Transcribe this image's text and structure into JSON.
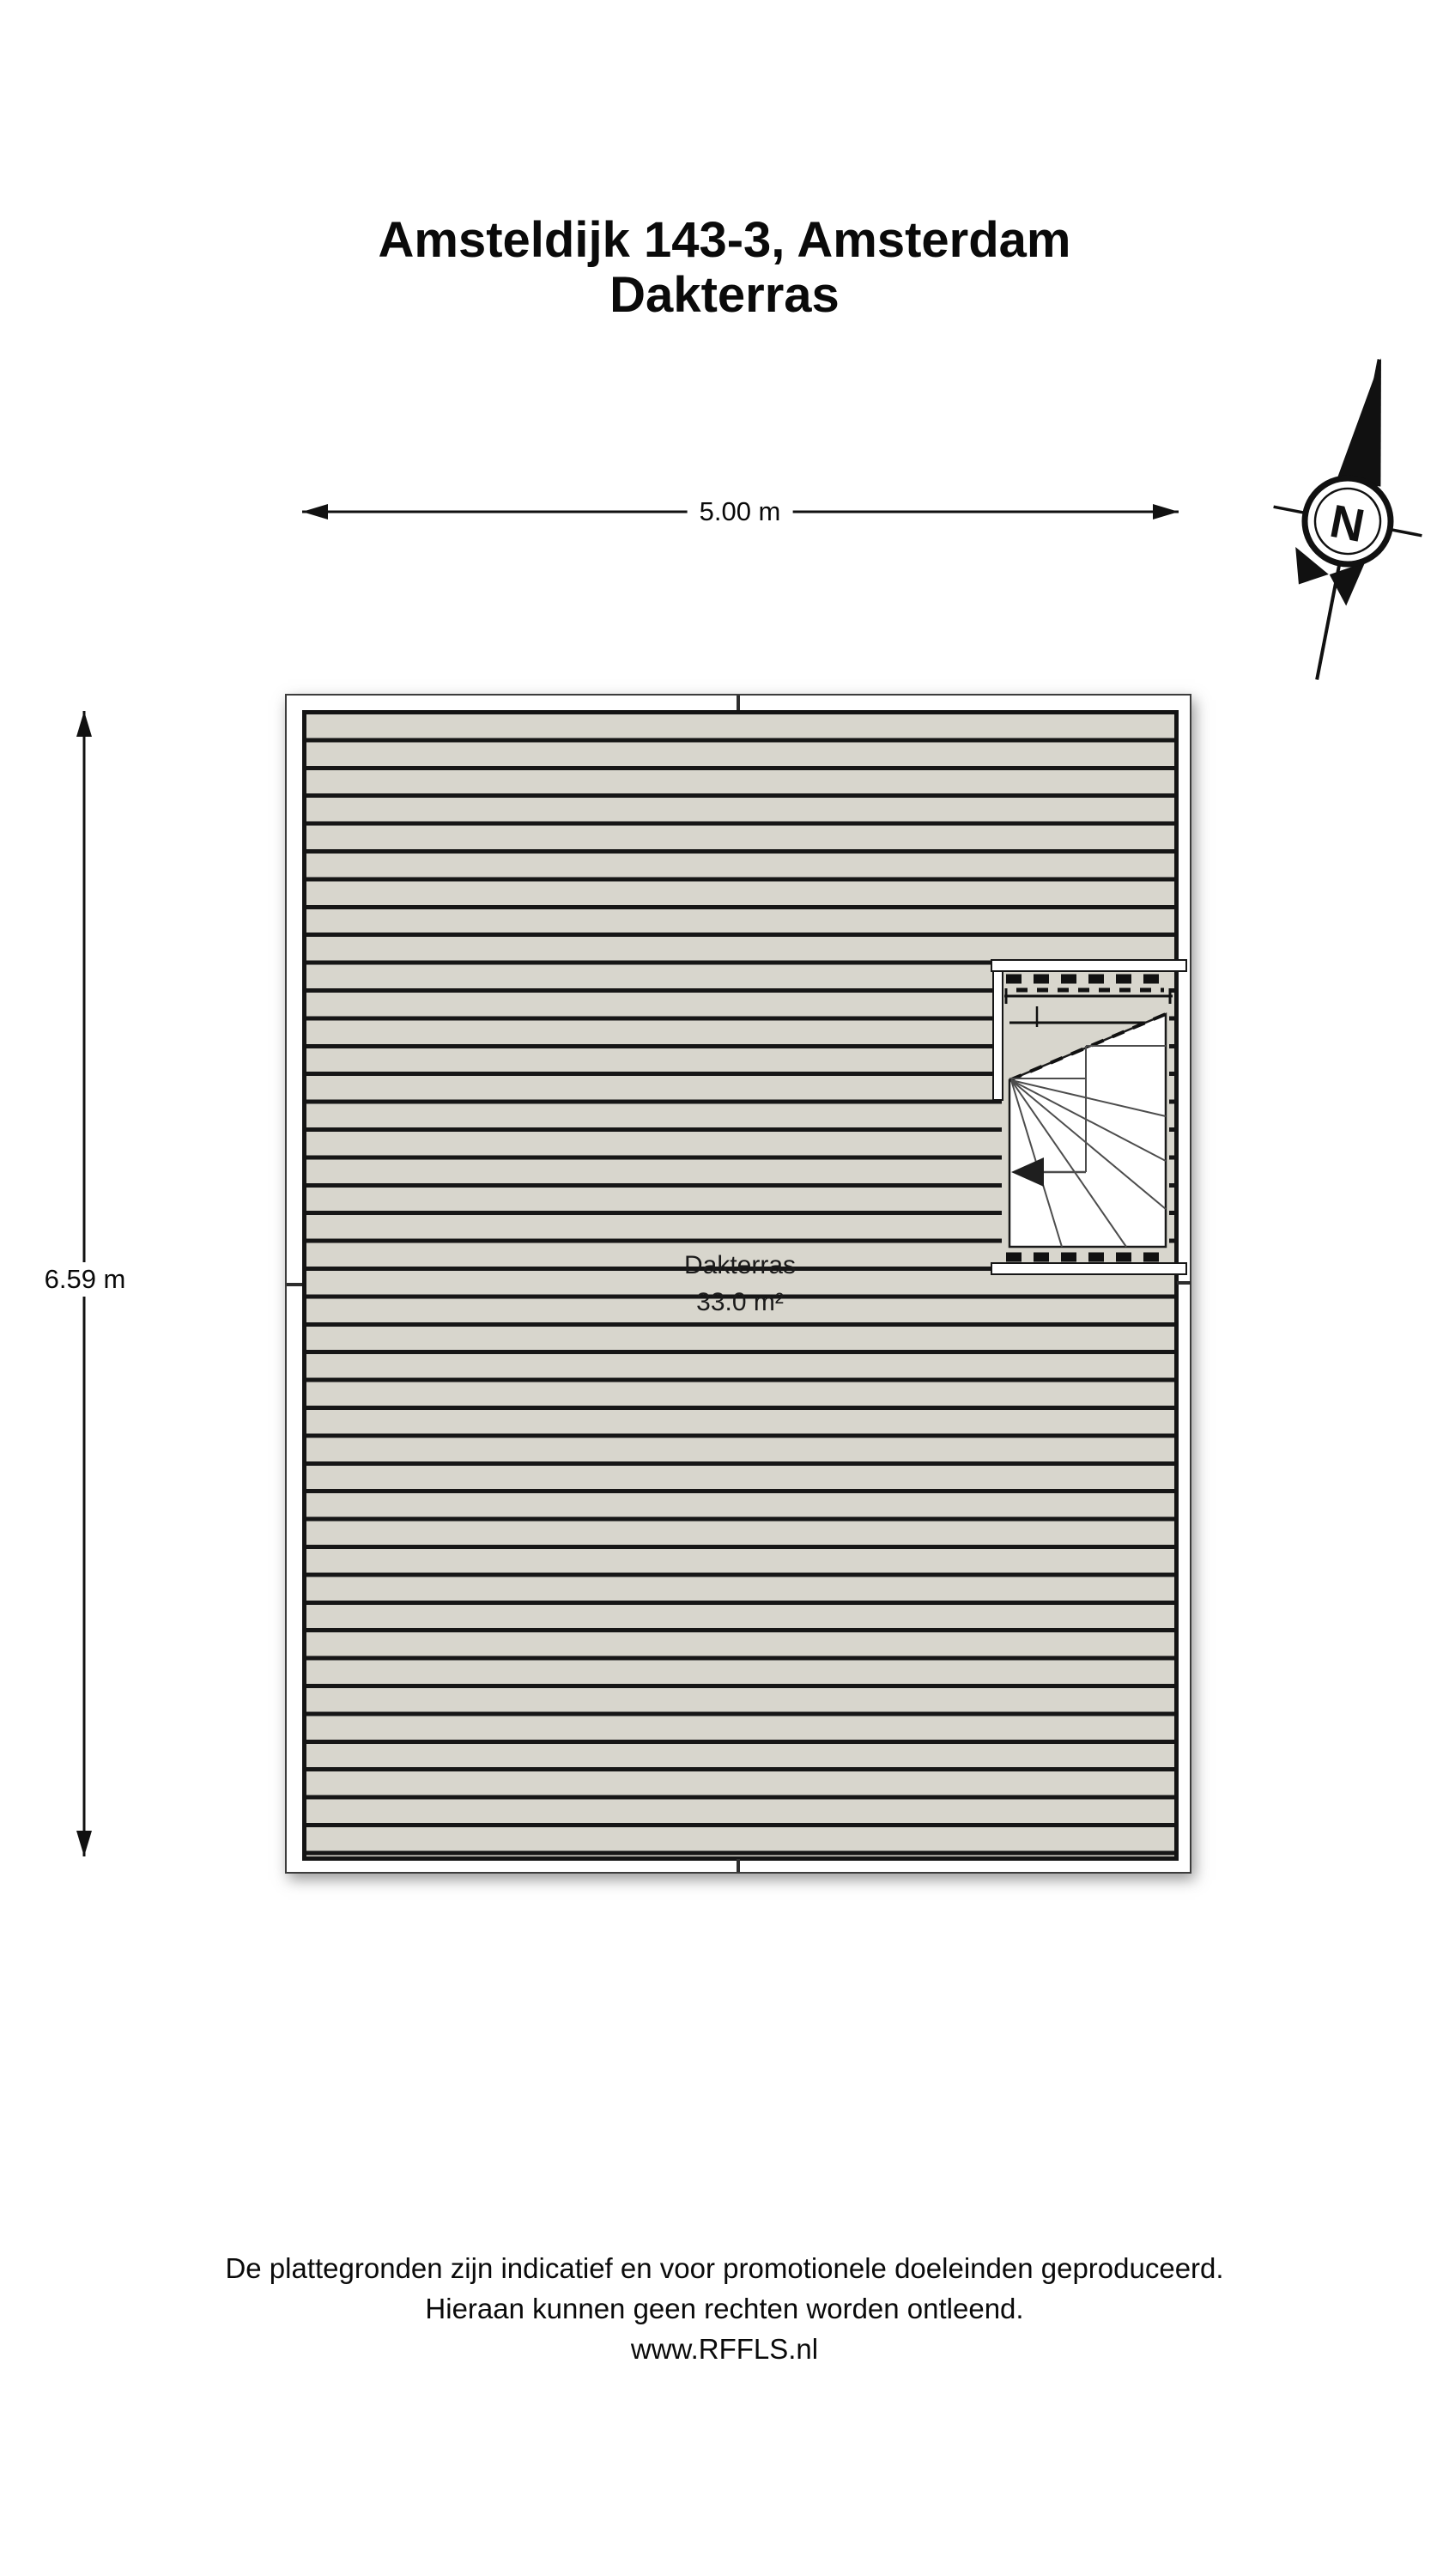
{
  "title": {
    "line1": "Amsteldijk 143-3, Amsterdam",
    "line2": "Dakterras"
  },
  "compass": {
    "north_label": "N"
  },
  "dimensions": {
    "width_label": "5.00 m",
    "height_label": "6.59 m"
  },
  "room": {
    "name": "Dakterras",
    "area": "33.0 m²"
  },
  "footer": {
    "lines": [
      "De plattegronden zijn indicatief en voor promotionele doeleinden geproduceerd.",
      "Hieraan kunnen geen rechten worden ontleend.",
      "www.RFFLS.nl"
    ]
  },
  "colors": {
    "deck_fill": "#d8d6cd",
    "plank_line": "#161616",
    "ink": "#0a0a0a",
    "background": "#ffffff"
  }
}
